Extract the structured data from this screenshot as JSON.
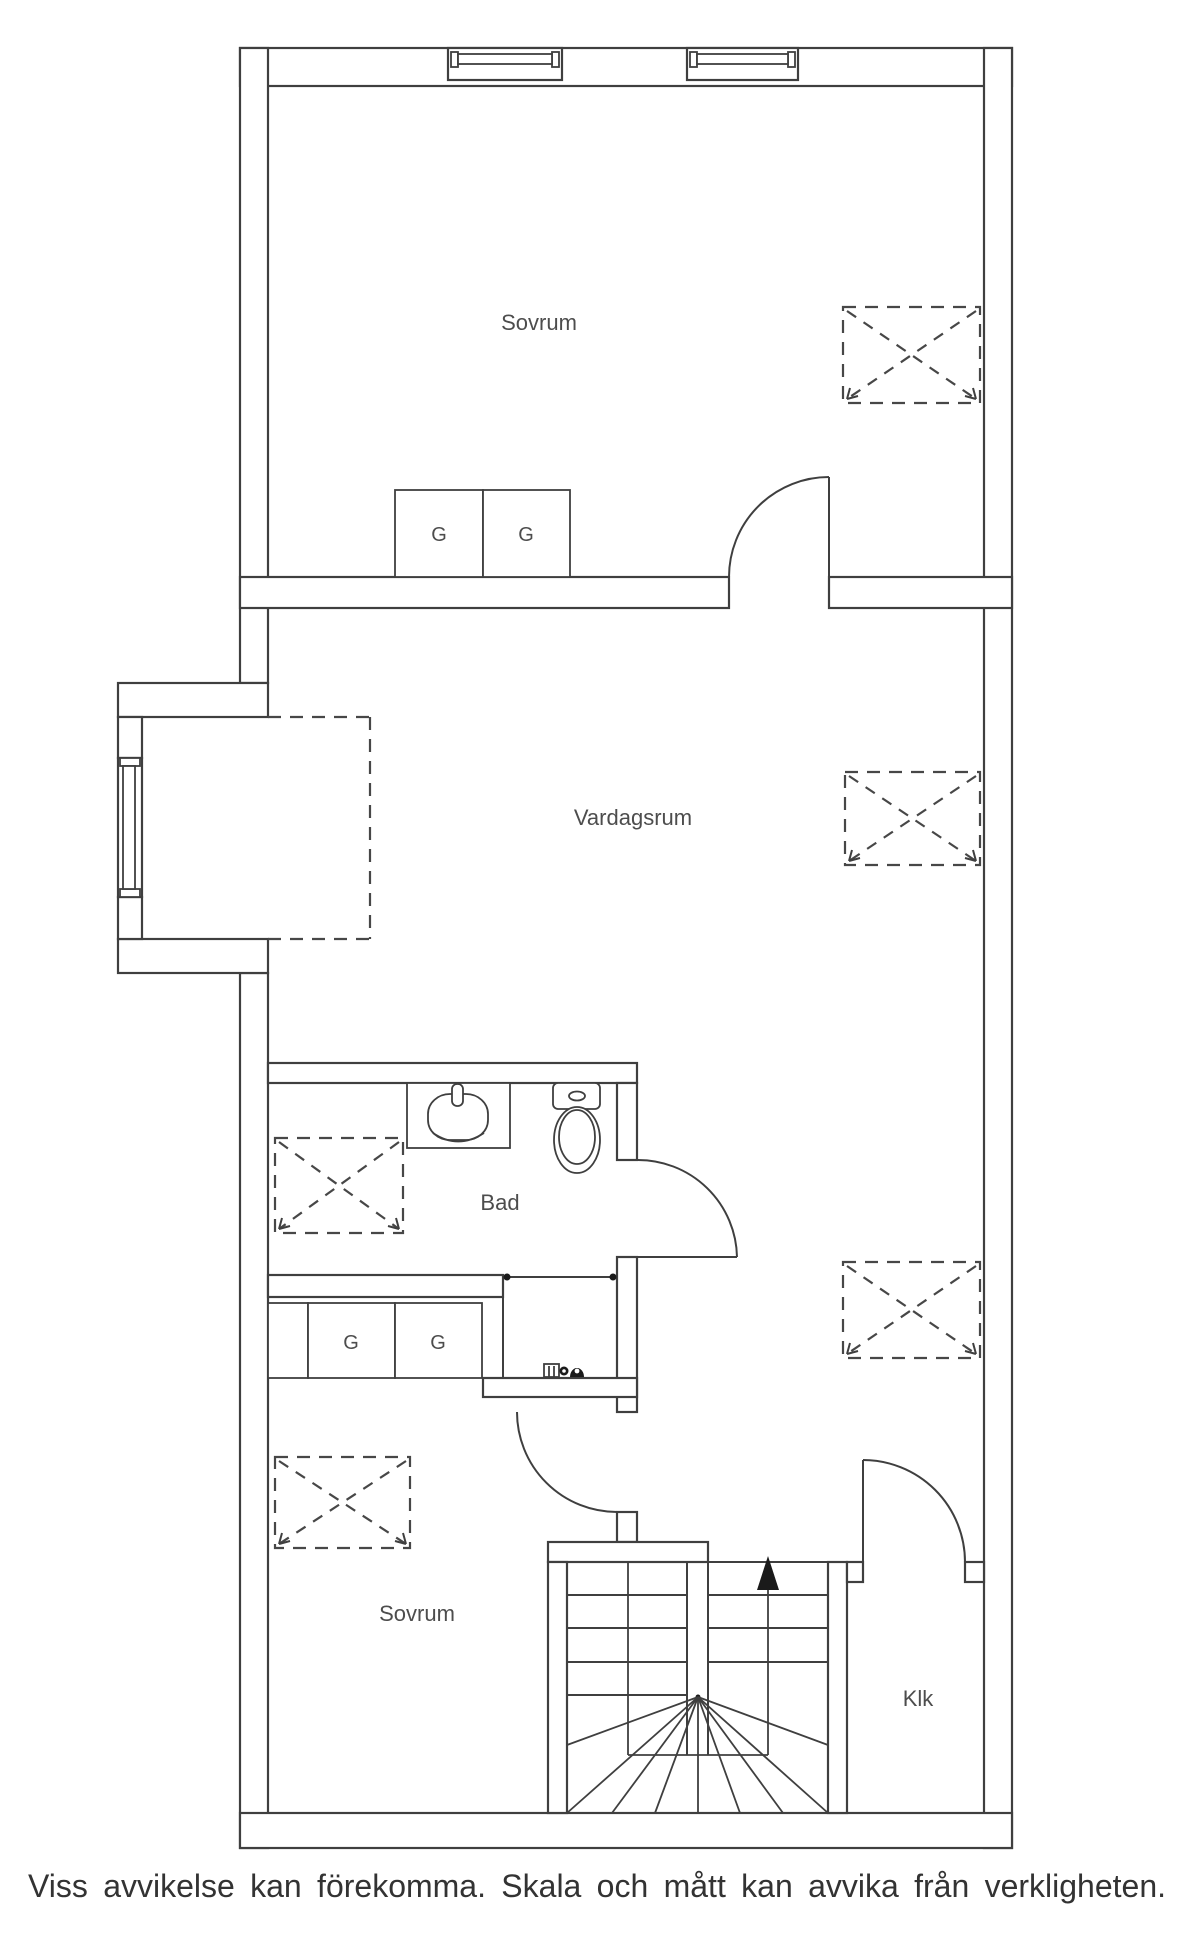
{
  "plan": {
    "rooms": {
      "bedroom_upper": "Sovrum",
      "living_room": "Vardagsrum",
      "bathroom": "Bad",
      "bedroom_lower": "Sovrum",
      "closet": "Klk"
    },
    "wardrobe_label": "G",
    "colors": {
      "line": "#3f3f3f",
      "label": "#4d4d4d",
      "arrow": "#1a1a1a",
      "background": "#ffffff"
    },
    "icons": [
      "window-icon",
      "door-swing-icon",
      "skylight-icon",
      "wardrobe-icon",
      "sink-icon",
      "toilet-icon",
      "stair-up-arrow-icon",
      "opening-marker-icon",
      "utility-fixtures-icon",
      "staircase-icon"
    ]
  },
  "footer": {
    "disclaimer": "Viss avvikelse kan förekomma. Skala och mått kan avvika från verkligheten."
  }
}
